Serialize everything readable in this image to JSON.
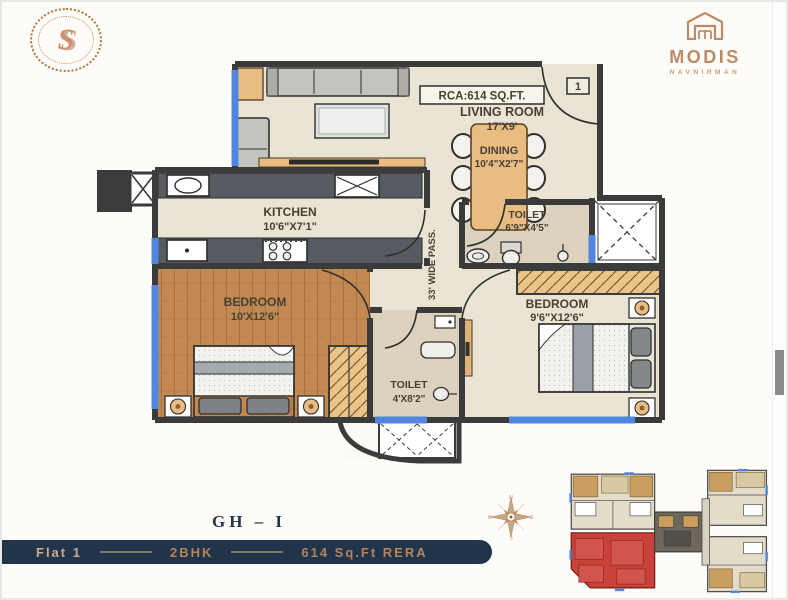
{
  "brand": {
    "monogram": "S",
    "name": "MODIS",
    "subtitle": "NAVNIRMAN"
  },
  "plan": {
    "rca": "RCA:614 SQ.FT.",
    "entrance_marker": "1",
    "passage": "33' WIDE PASS.",
    "living": {
      "name": "LIVING ROOM",
      "dims": "17'X9'"
    },
    "dining": {
      "name": "DINING",
      "dims": "10'4\"X2'7\""
    },
    "kitchen": {
      "name": "KITCHEN",
      "dims": "10'6\"X7'1\""
    },
    "toilet_common": {
      "name": "TOILET",
      "dims": "6'9\"X4'5\""
    },
    "bedroom_left": {
      "name": "BEDROOM",
      "dims": "10'X12'6\""
    },
    "bedroom_right": {
      "name": "BEDROOM",
      "dims": "9'6\"X12'6\""
    },
    "toilet_attached": {
      "name": "TOILET",
      "dims": "4'X8'2\""
    }
  },
  "compass": {
    "n": "N",
    "e": "E",
    "s": "S",
    "w": "W"
  },
  "footer": {
    "unit_code": "GH – I",
    "flat": "Flat 1",
    "type": "2BHK",
    "area": "614 Sq.Ft RERA"
  },
  "colors": {
    "copper": "#bd8a64",
    "navy": "#20344a",
    "wall": "#3b3b3b",
    "window_blue": "#4f86e0",
    "floor_beige": "#e9e4d4",
    "floor_wood": "#c28a52",
    "floor_marble": "#ddd2bd",
    "highlight_red": "#c8423a"
  }
}
